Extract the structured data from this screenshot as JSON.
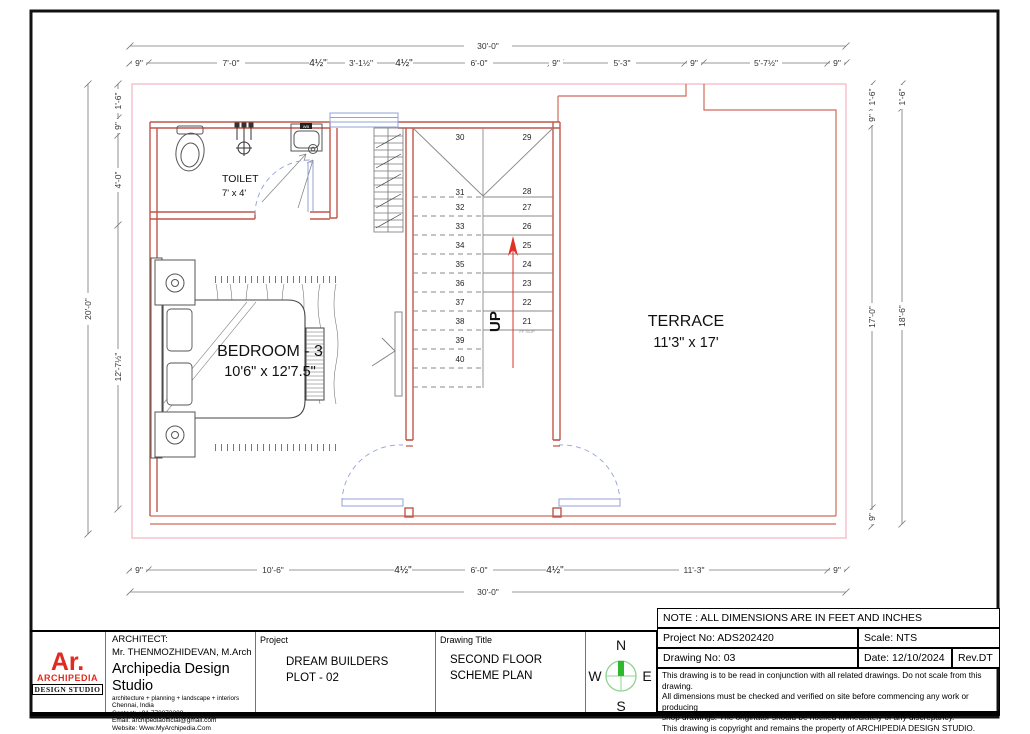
{
  "plan": {
    "rooms": {
      "toilet": {
        "name": "TOILET",
        "size": "7' x 4'"
      },
      "bedroom": {
        "name": "BEDROOM - 3",
        "size": "10'6\" x 12'7.5\""
      },
      "terrace": {
        "name": "TERRACE",
        "size": "11'3\" x 17'"
      }
    },
    "stairs": {
      "up_label": "UP",
      "landing_note": "FF S/UP",
      "left": [
        "30",
        "31",
        "32",
        "33",
        "34",
        "35",
        "36",
        "37",
        "38",
        "39",
        "40"
      ],
      "right": [
        "29",
        "28",
        "27",
        "26",
        "25",
        "24",
        "23",
        "22",
        "21"
      ]
    },
    "fixtures": {
      "washbasin_label": "WB"
    }
  },
  "dims": {
    "top_total": "30'-0\"",
    "top": [
      "9\"",
      "7'-0\"",
      "4½\"",
      "3'-1½\"",
      "4½\"",
      "6'-0\"",
      "9\"",
      "5'-3\"",
      "9\"",
      "5'-7½\"",
      "9\""
    ],
    "bottom": [
      "9\"",
      "10'-6\"",
      "4½\"",
      "6'-0\"",
      "4½\"",
      "11'-3\"",
      "9\""
    ],
    "bottom_total": "30'-0\"",
    "left_outer": "20'-0\"",
    "left_inner": [
      "1'-6\"",
      "9\"",
      "4'-0\"",
      "12'-7½\""
    ],
    "right_inner": [
      "1'-6\"",
      "9\"",
      "17'-0\"",
      "9\""
    ],
    "right_outer": [
      "1'-6\"",
      "18'-6\""
    ]
  },
  "titleblock": {
    "logo": {
      "line1": "Ar.",
      "line2": "ARCHIPEDIA",
      "line3": "DESIGN STUDIO"
    },
    "architect": {
      "label": "ARCHITECT:",
      "name": "Mr. THENMOZHIDEVAN, M.Arch",
      "studio": "Archipedia Design Studio",
      "tagline": "architecture + planning + landscape + interiors",
      "city": "Chennai, India",
      "contact": "Contact: +91 770872208",
      "email": "Email: archipediaofficial@gmail.com",
      "website": "Website: Www.MyArchipedia.Com"
    },
    "project": {
      "label": "Project",
      "line1": "DREAM BUILDERS",
      "line2": "PLOT - 02"
    },
    "drawing_title": {
      "label": "Drawing Title",
      "line1": "SECOND FLOOR",
      "line2": "SCHEME PLAN"
    },
    "compass": {
      "n": "N",
      "s": "S",
      "e": "E",
      "w": "W"
    },
    "right": {
      "note": "NOTE : ALL DIMENSIONS ARE IN FEET AND INCHES",
      "project_no_label": "Project No:  ADS202420",
      "scale_label": "Scale: NTS",
      "drawing_no_label": "Drawing No:  03",
      "date_label": "Date: 12/10/2024",
      "rev_label": "Rev.DT",
      "disclaimer": [
        "This drawing is to be read in conjunction with all related drawings. Do not scale from this drawing.",
        "All dimensions must be checked and verified on site before commencing any work or producing",
        "shop drawings. The originator should be notified immediately of any discrepancy.",
        "This drawing is copyright and remains the property of ARCHIPEDIA DESIGN STUDIO."
      ]
    }
  }
}
